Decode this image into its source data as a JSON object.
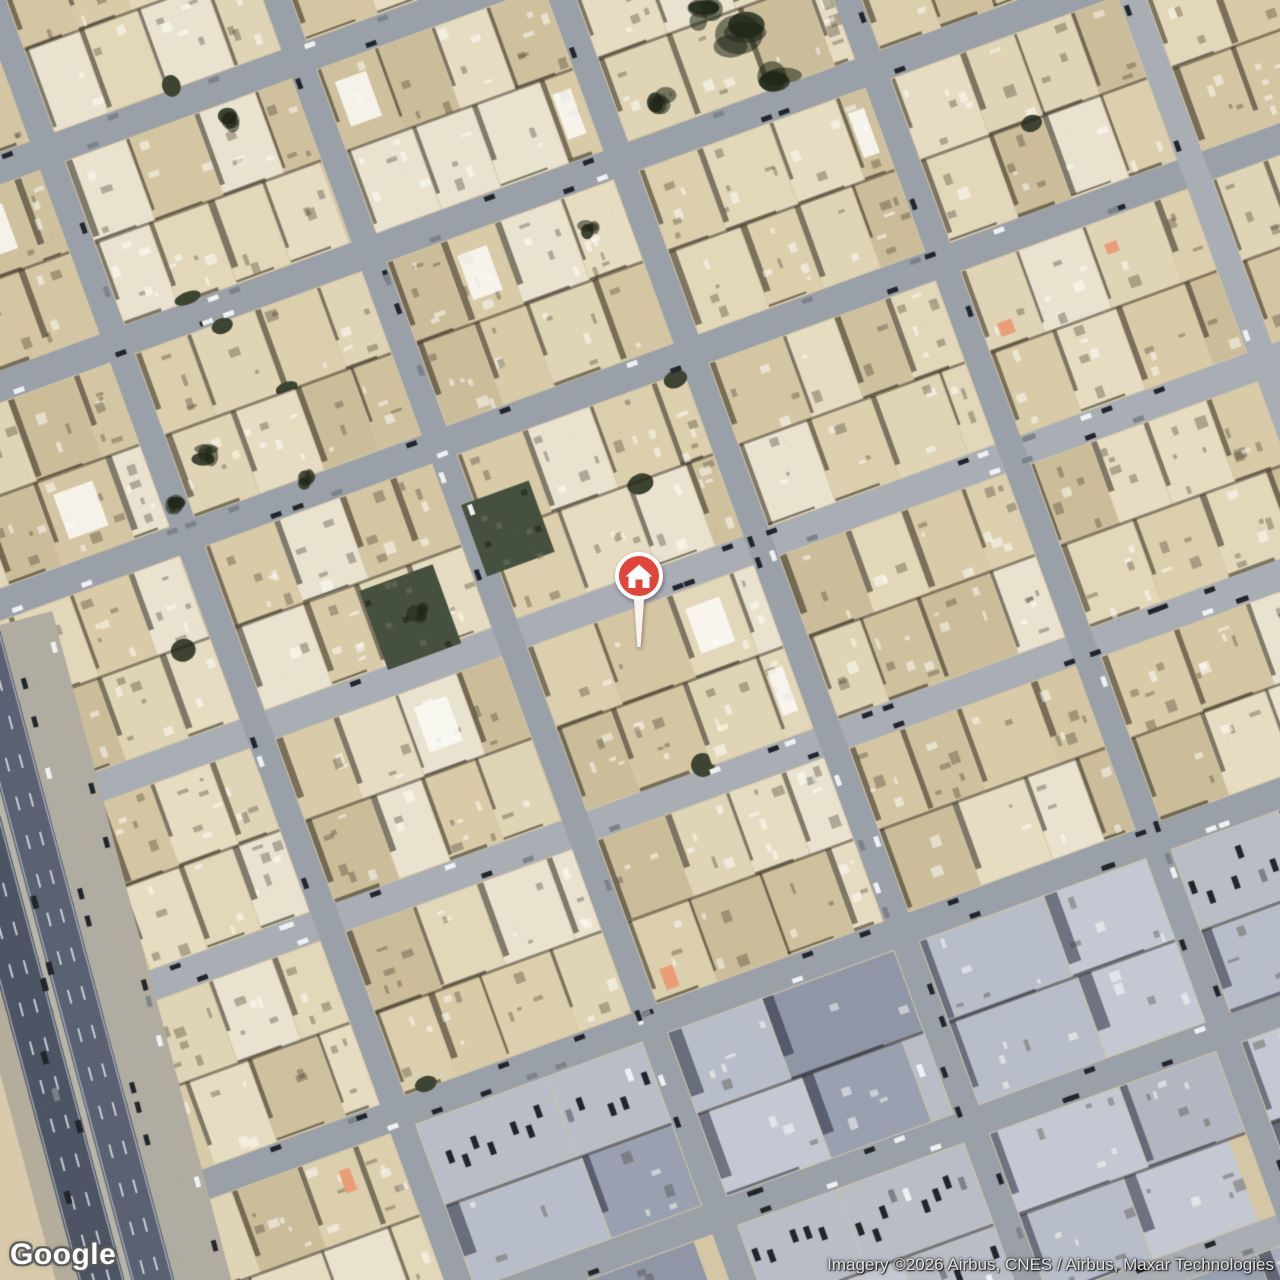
{
  "map": {
    "view_label": "Satellite map view",
    "google_logo_text": "Google",
    "attribution_text": "Imagery ©2026 Airbus, CNES / Airbus, Maxar Technologies",
    "marker": {
      "type": "home-pin",
      "color": "#E0443A",
      "screen_x": 639,
      "screen_y": 576
    },
    "palette": {
      "base": "#d5c6a6",
      "sand": "#d9caab",
      "building_shades": [
        "#dccfae",
        "#d5c6a3",
        "#e0d4b6",
        "#cfc09e",
        "#e6dcc2",
        "#d9cba8",
        "#cbbc9a",
        "#e3d7ba",
        "#e9e2cf"
      ],
      "commercial_shades": [
        "#a7aeba",
        "#b8bec9",
        "#99a1b0",
        "#c3c8d2",
        "#8f97a7",
        "#b1b6c0"
      ],
      "street": "#9aa0a8",
      "street_light": "#a9aeb4",
      "highway_dark": "#4d5565",
      "highway_dark2": "#596172",
      "median": "#b8b4a8",
      "service_road": "#b0aca1",
      "shoulder": "#b5ad9b",
      "lane_marking": "#f2f3f4",
      "car_dark": "#22262c",
      "car_white": "#eef0f2",
      "car_gray": "#7d828a",
      "shadow": "rgba(42,36,26,0.55)",
      "commercial_shadow": "rgba(25,30,48,0.5)",
      "tree": "#3e4432",
      "garden": "#46503f",
      "orange_roof": "#eb9d78"
    }
  }
}
